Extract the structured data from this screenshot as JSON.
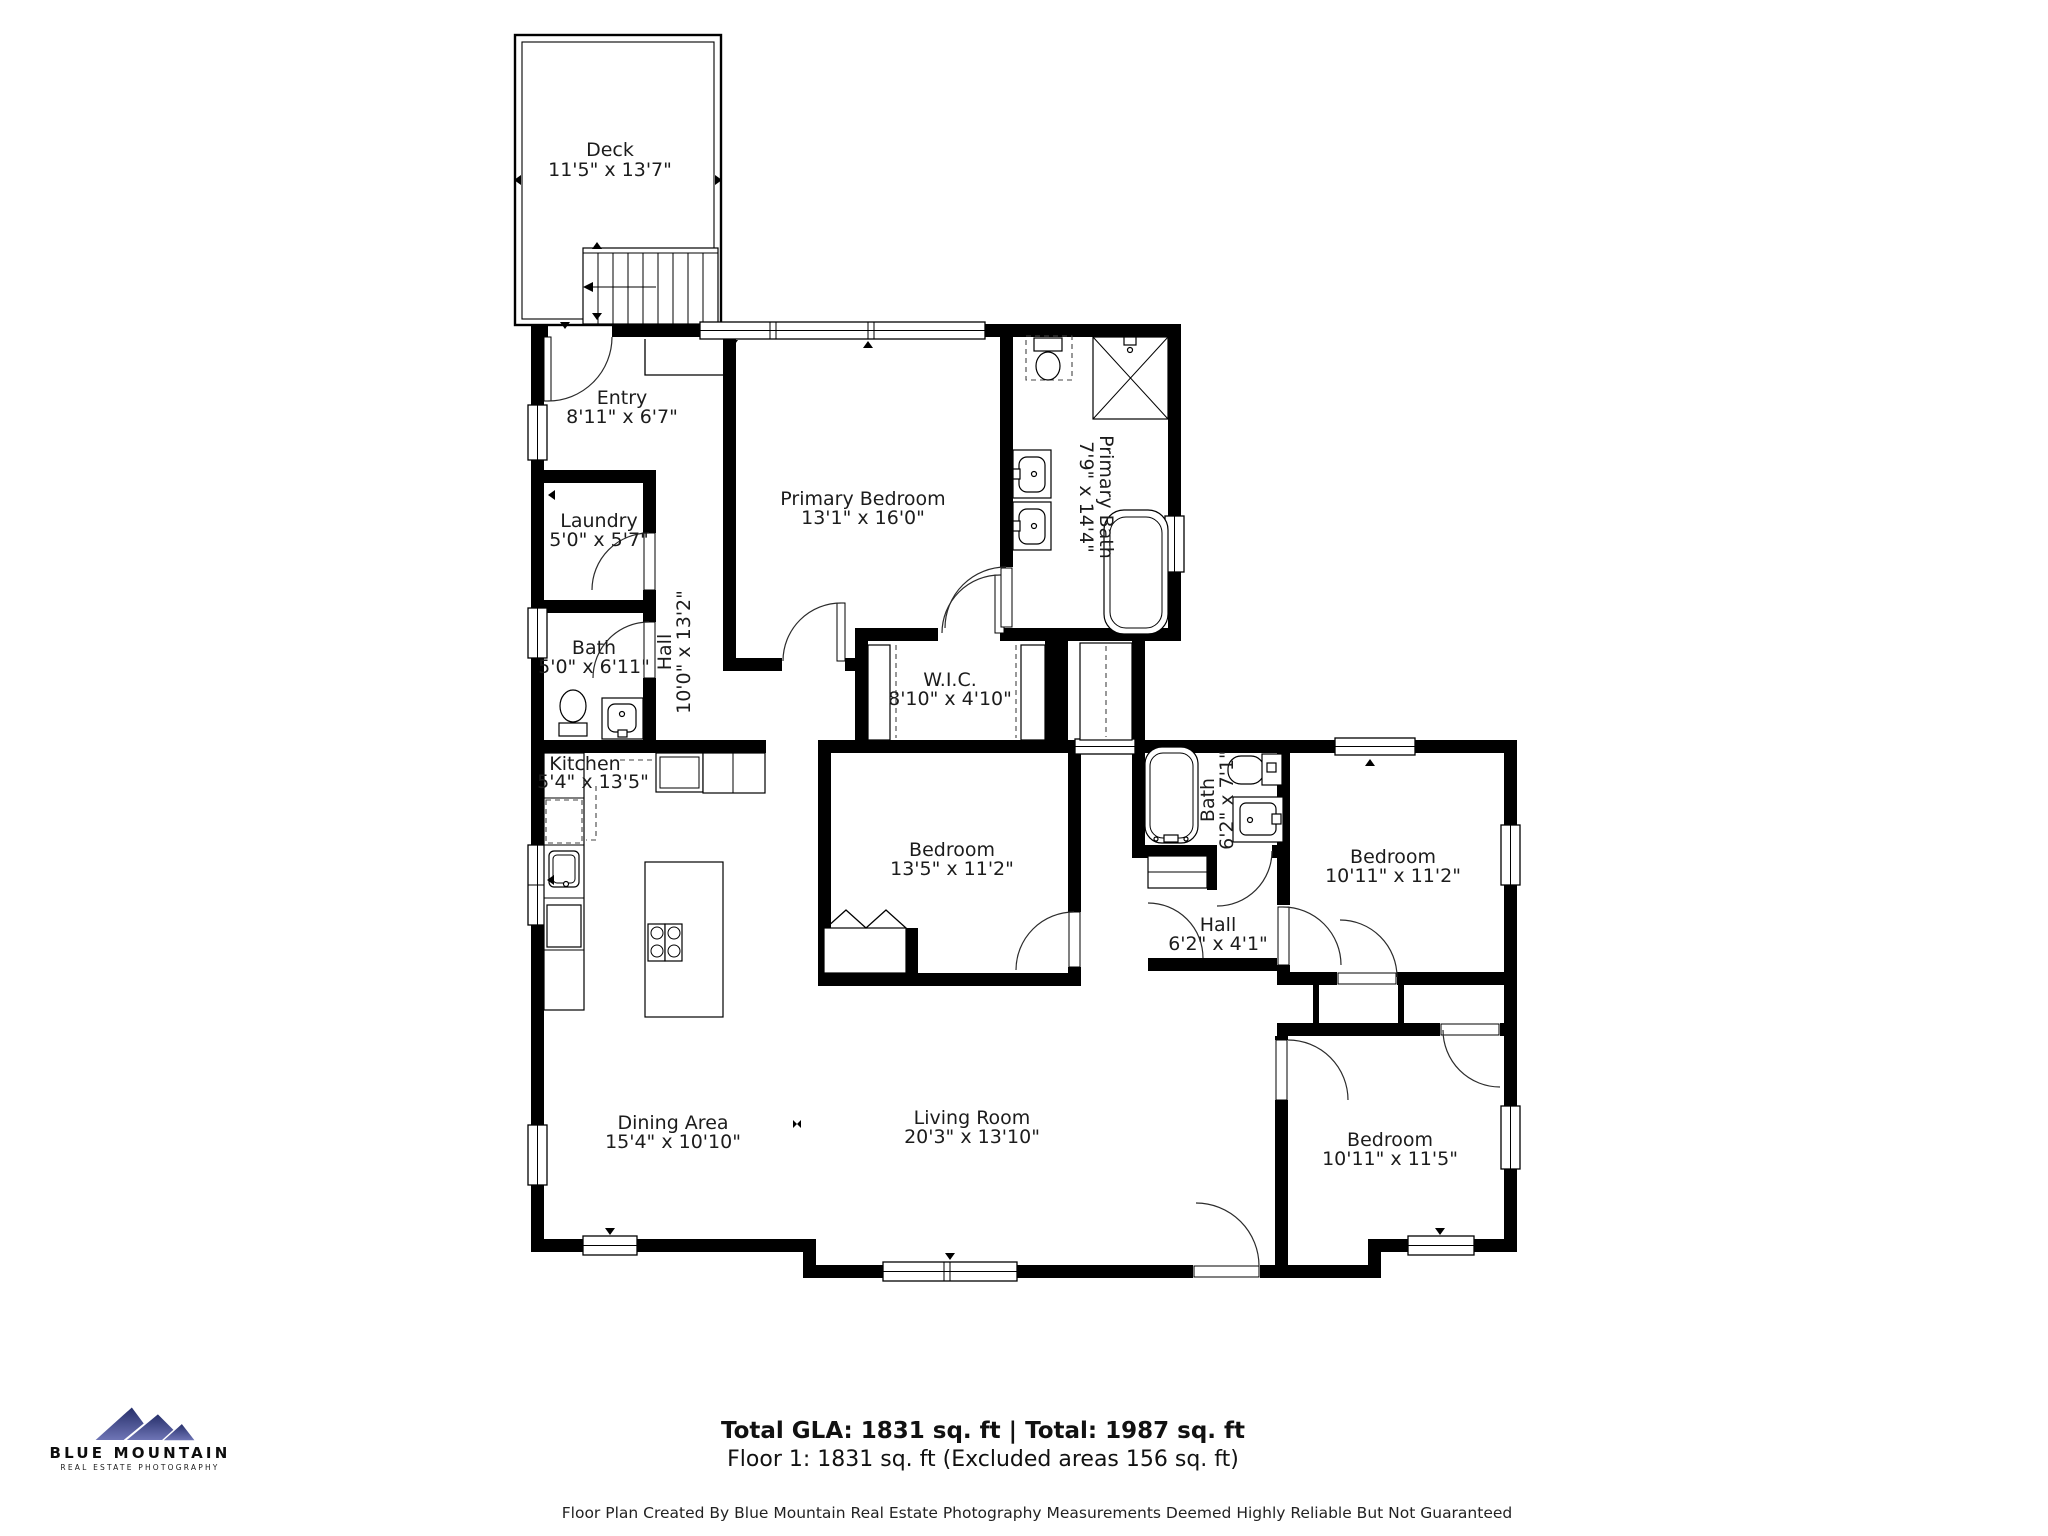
{
  "plan": {
    "rooms": {
      "deck": {
        "name": "Deck",
        "dims": "11'5\" x 13'7\""
      },
      "entry": {
        "name": "Entry",
        "dims": "8'11\" x 6'7\""
      },
      "laundry": {
        "name": "Laundry",
        "dims": "5'0\" x 5'7\""
      },
      "bath_main": {
        "name": "Bath",
        "dims": "5'0\" x 6'11\""
      },
      "hall_main": {
        "name": "Hall",
        "dims": "10'0\" x 13'2\""
      },
      "primary_bedroom": {
        "name": "Primary Bedroom",
        "dims": "13'1\" x 16'0\""
      },
      "primary_bath": {
        "name": "Primary Bath",
        "dims": "7'9\" x 14'4\""
      },
      "wic": {
        "name": "W.I.C.",
        "dims": "8'10\" x 4'10\""
      },
      "kitchen": {
        "name": "Kitchen",
        "dims": "5'4\" x 13'5\""
      },
      "bedroom_middle": {
        "name": "Bedroom",
        "dims": "13'5\" x 11'2\""
      },
      "bath_hall": {
        "name": "Bath",
        "dims": "6'2\" x 7'1\""
      },
      "bedroom_upper_right": {
        "name": "Bedroom",
        "dims": "10'11\" x 11'2\""
      },
      "hall_small": {
        "name": "Hall",
        "dims": "6'2\" x 4'1\""
      },
      "dining": {
        "name": "Dining Area",
        "dims": "15'4\" x 10'10\""
      },
      "living": {
        "name": "Living Room",
        "dims": "20'3\" x 13'10\""
      },
      "bedroom_lower_right": {
        "name": "Bedroom",
        "dims": "10'11\" x 11'5\""
      }
    }
  },
  "footer": {
    "totals": "Total GLA: 1831 sq. ft | Total: 1987 sq. ft",
    "floor": "Floor 1: 1831 sq. ft (Excluded areas 156 sq. ft)",
    "disclaimer": "Floor Plan Created By Blue Mountain Real Estate Photography Measurements Deemed Highly Reliable But Not Guaranteed"
  },
  "logo": {
    "name": "BLUE MOUNTAIN",
    "tagline": "REAL ESTATE PHOTOGRAPHY"
  },
  "colors": {
    "wall": "#000000",
    "text": "#1c1c1c",
    "logo_top": "#232c67",
    "logo_bottom": "#7177b8"
  }
}
